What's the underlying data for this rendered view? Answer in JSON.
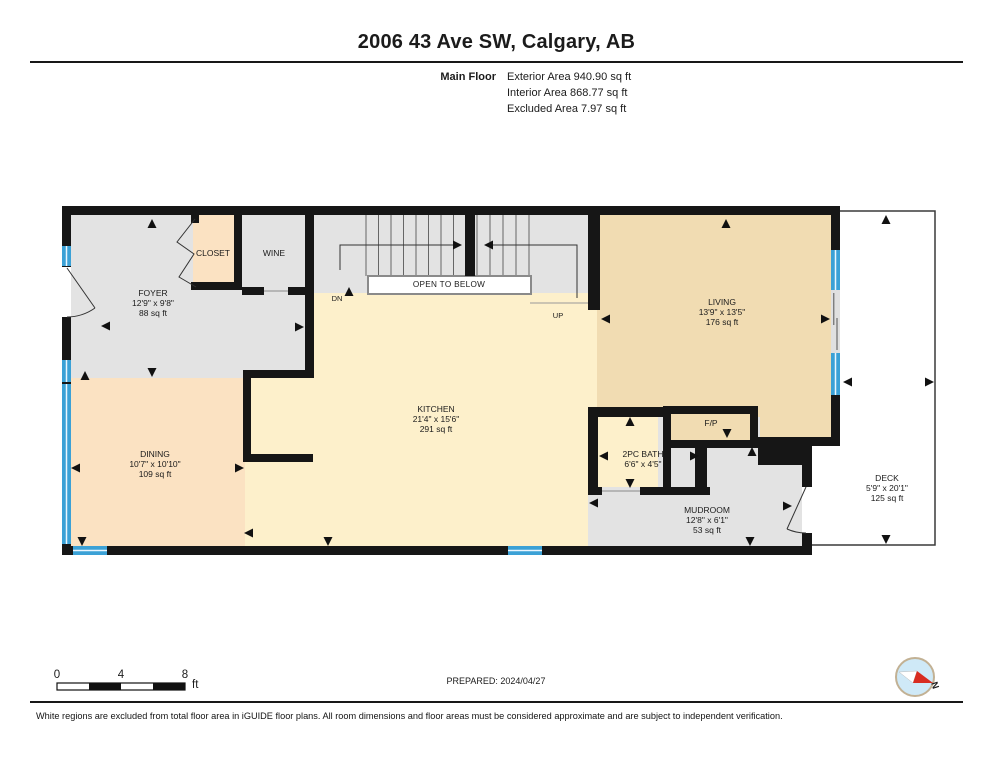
{
  "header": {
    "title": "2006 43 Ave SW, Calgary, AB",
    "floor_label": "Main Floor",
    "areas": [
      "Exterior Area 940.90 sq ft",
      "Interior Area 868.77 sq ft",
      "Excluded Area 7.97 sq ft"
    ]
  },
  "rooms": {
    "foyer": {
      "name": "FOYER",
      "dims": "12'9\" x 9'8\"",
      "area": "88 sq ft"
    },
    "closet": {
      "name": "CLOSET"
    },
    "wine": {
      "name": "WINE"
    },
    "dining": {
      "name": "DINING",
      "dims": "10'7\" x 10'10\"",
      "area": "109 sq ft"
    },
    "kitchen": {
      "name": "KITCHEN",
      "dims": "21'4\" x 15'6\"",
      "area": "291 sq ft"
    },
    "living": {
      "name": "LIVING",
      "dims": "13'9\" x 13'5\"",
      "area": "176 sq ft"
    },
    "bath": {
      "name": "2PC BATH",
      "dims": "6'6\" x 4'5\""
    },
    "fireplace:": {
      "name": "F/P"
    },
    "fireplace": {
      "name": "F/P"
    },
    "mudroom": {
      "name": "MUDROOM",
      "dims": "12'8\" x 6'1\"",
      "area": "53 sq ft"
    },
    "deck": {
      "name": "DECK",
      "dims": "5'9\" x 20'1\"",
      "area": "125 sq ft"
    }
  },
  "stairs": {
    "open_to_below": "OPEN TO BELOW",
    "dn": "DN",
    "up": "UP"
  },
  "scale_bar": {
    "ticks": [
      "0",
      "4",
      "8"
    ],
    "unit": "ft"
  },
  "footer": {
    "prepared": "PREPARED: 2024/04/27",
    "compass_label": "N",
    "disclaimer": "White regions are excluded from total floor area in iGUIDE floor plans. All room dimensions and floor areas must be considered approximate and are subject to independent verification."
  },
  "colors": {
    "wall": "#161616",
    "floor_gray": "#e3e3e3",
    "floor_tan": "#f1dcb2",
    "floor_yellow": "#fdf0cb",
    "floor_peach": "#fbe2c2",
    "window_blue": "#3ba1d6",
    "compass_red": "#d82c20"
  }
}
